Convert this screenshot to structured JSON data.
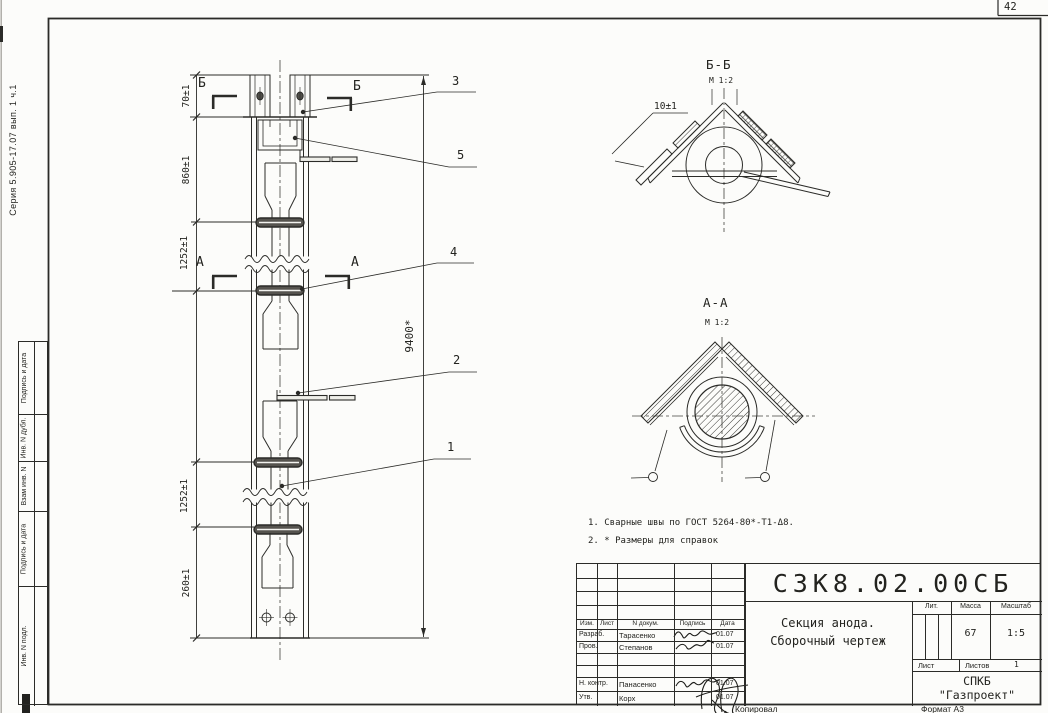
{
  "sheet": {
    "page_number": "42",
    "series_note": "Серия 5.905-17.07 вып. 1 ч.1",
    "copied_label": "Копировал",
    "format_label": "Формат А3"
  },
  "margin_stamps": [
    "Подпись и дата",
    "Инв. N дубл.",
    "Взам инв. N",
    "Подпись и дата",
    "Инв. N подл."
  ],
  "front_view": {
    "dim_70": "70±1",
    "dim_860": "860±1",
    "dim_1252_top": "1252±1",
    "dim_1252_bottom": "1252±1",
    "dim_260": "260±1",
    "dim_overall": "9400*",
    "section_mark_b": "Б",
    "section_mark_a": "А",
    "callout_1": "1",
    "callout_2": "2",
    "callout_3": "3",
    "callout_4": "4",
    "callout_5": "5"
  },
  "section_bb": {
    "title": "Б-Б",
    "scale": "М 1:2",
    "dim_10": "10±1"
  },
  "section_aa": {
    "title": "А-А",
    "scale": "М 1:2"
  },
  "notes": [
    "1. Сварные швы по ГОСТ 5264-80*-Т1-Δ8.",
    "2. * Размеры для справок"
  ],
  "title_block": {
    "doc_number": "СЗК8.02.00СБ",
    "title_line1": "Секция анода.",
    "title_line2": "Сборочный чертеж",
    "col_izm": "Изм.",
    "col_list": "Лист",
    "col_doc": "N докум.",
    "col_sign": "Подпись",
    "col_date": "Дата",
    "rows": [
      {
        "role": "Разраб.",
        "name": "Тарасенко",
        "date": "01.07"
      },
      {
        "role": "Пров.",
        "name": "Степанов",
        "date": "01.07"
      },
      {
        "role": "Н. контр.",
        "name": "Панасенко",
        "date": "01.07"
      },
      {
        "role": "Утв.",
        "name": "Корх",
        "date": "01.07"
      }
    ],
    "lit_label": "Лит.",
    "mass_label": "Масса",
    "mass_value": "67",
    "scale_label": "Масштаб",
    "scale_value": "1:5",
    "sheet_label": "Лист",
    "sheets_label": "Листов",
    "sheets_value": "1",
    "org_line1": "СПКБ",
    "org_line2": "\"Газпроект\""
  }
}
